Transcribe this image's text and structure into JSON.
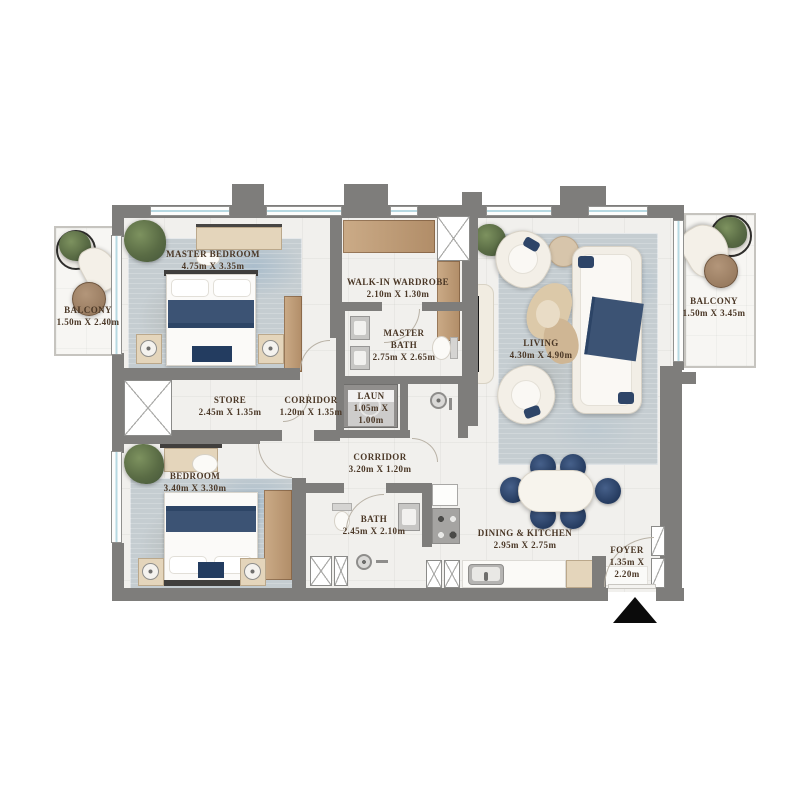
{
  "colors": {
    "wall": "#7e7d7b",
    "floor": "#f1f0ed",
    "label_text": "#4a3726",
    "navy_furniture": "#3c5374",
    "wood": "#bf9c77",
    "glass": "#b7d9e2",
    "entrance_marker": "#0b0b0b"
  },
  "icons": {
    "entrance_marker": "triangle-up"
  },
  "rooms": {
    "master_bedroom": {
      "name": "MASTER BEDROOM",
      "dims": "4.75m X 3.35m"
    },
    "balcony_left": {
      "name": "BALCONY",
      "dims": "1.50m X 2.40m"
    },
    "walk_in_wardrobe": {
      "name": "WALK-IN WARDROBE",
      "dims": "2.10m X 1.30m"
    },
    "master_bath": {
      "name": "MASTER BATH",
      "dims": "2.75m X 2.65m"
    },
    "living": {
      "name": "LIVING",
      "dims": "4.30m X 4.90m"
    },
    "balcony_right": {
      "name": "BALCONY",
      "dims": "1.50m X 3.45m"
    },
    "store": {
      "name": "STORE",
      "dims": "2.45m X 1.35m"
    },
    "corridor_small": {
      "name": "CORRIDOR",
      "dims": "1.20m X 1.35m"
    },
    "laundry": {
      "name": "LAUN",
      "dims": "1.05m X 1.00m"
    },
    "corridor_main": {
      "name": "CORRIDOR",
      "dims": "3.20m X 1.20m"
    },
    "bedroom": {
      "name": "BEDROOM",
      "dims": "3.40m X 3.30m"
    },
    "bath": {
      "name": "BATH",
      "dims": "2.45m X 2.10m"
    },
    "dining_kitchen": {
      "name": "DINING & KITCHEN",
      "dims": "2.95m X 2.75m"
    },
    "foyer": {
      "name": "FOYER",
      "dims": "1.35m X 2.20m"
    }
  }
}
